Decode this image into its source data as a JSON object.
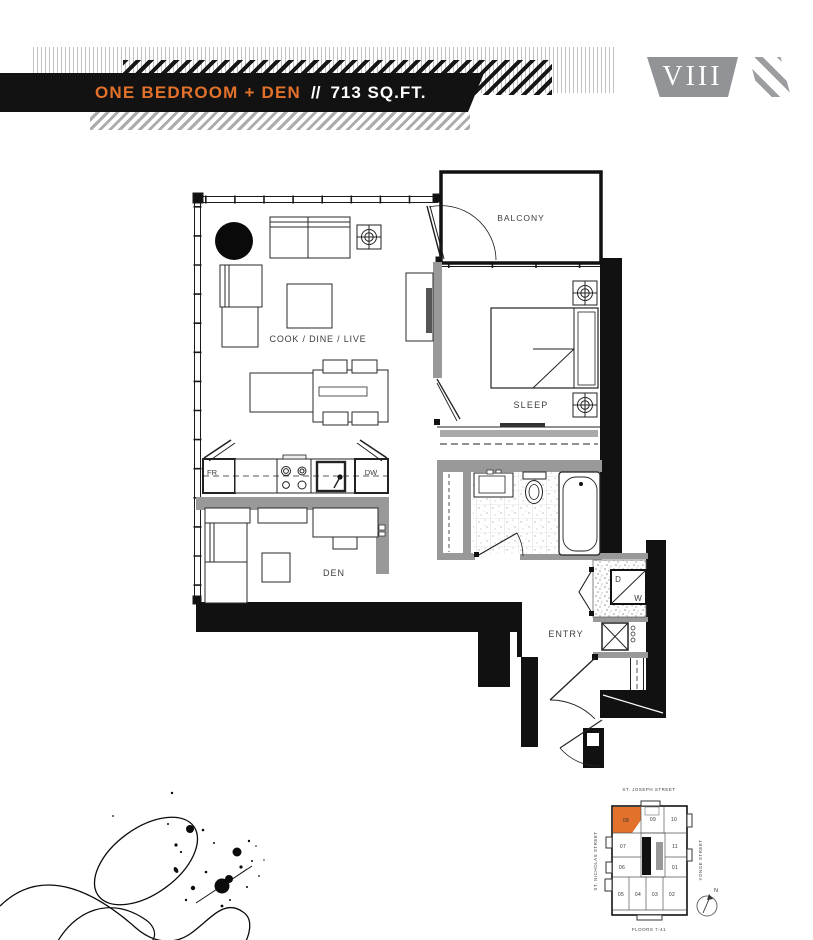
{
  "header": {
    "title": "ONE BEDROOM + DEN",
    "separator": "//",
    "area": "713 SQ.FT.",
    "badge": "VIII"
  },
  "colors": {
    "accent_orange": "#E2712B",
    "badge_gray": "#919396",
    "ink_black": "#121212"
  },
  "plan": {
    "rooms": {
      "balcony": "BALCONY",
      "living": "COOK / DINE / LIVE",
      "sleep": "SLEEP",
      "den": "DEN",
      "entry": "ENTRY"
    },
    "appliances": {
      "fridge": "FR",
      "dishwasher": "DW",
      "dryer": "D",
      "washer": "W"
    }
  },
  "keyplan": {
    "street_top": "ST. JOSEPH STREET",
    "street_left": "ST. NICHOLAS STREET",
    "street_right": "YONGE STREET",
    "floors_note": "FLOORS 7-41",
    "north": "N",
    "highlighted_unit": "08",
    "units": [
      "08",
      "09",
      "10",
      "07",
      "11",
      "06",
      "01",
      "05",
      "04",
      "03",
      "02"
    ]
  }
}
